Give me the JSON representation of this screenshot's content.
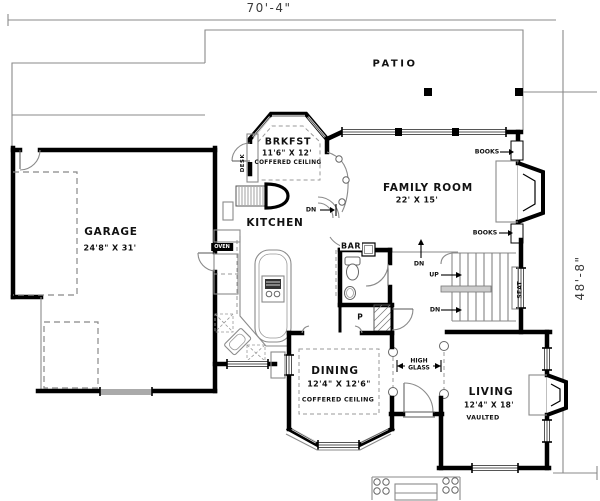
{
  "dimensions": {
    "width": "70'-4\"",
    "height": "48'-8\""
  },
  "rooms": {
    "patio": {
      "name": "PATIO"
    },
    "breakfast": {
      "name": "BRKFST",
      "size": "11'6\" X 12'",
      "ceiling": "COFFERED CEILING"
    },
    "family_room": {
      "name": "FAMILY ROOM",
      "size": "22' X 15'"
    },
    "garage": {
      "name": "GARAGE",
      "size": "24'8\" X 31'"
    },
    "kitchen": {
      "name": "KITCHEN"
    },
    "bar": {
      "name": "BAR"
    },
    "dining": {
      "name": "DINING",
      "size": "12'4\" X 12'6\"",
      "ceiling": "COFFERED CEILING"
    },
    "living": {
      "name": "LIVING",
      "size": "12'4\" X 18'",
      "ceiling": "VAULTED"
    }
  },
  "annotations": {
    "desk": "DESK",
    "oven": "OVEN",
    "pantry": "P",
    "seat": "SEAT",
    "books_top": "BOOKS",
    "books_bottom": "BOOKS",
    "stairs_up": "UP",
    "stairs_dn": "DN",
    "family_dn": "DN",
    "patio_dn": "DN",
    "high_glass": "HIGH GLASS"
  },
  "colors": {
    "walls": "#000000",
    "thin_lines": "#8a8a8a",
    "background": "#ffffff"
  }
}
